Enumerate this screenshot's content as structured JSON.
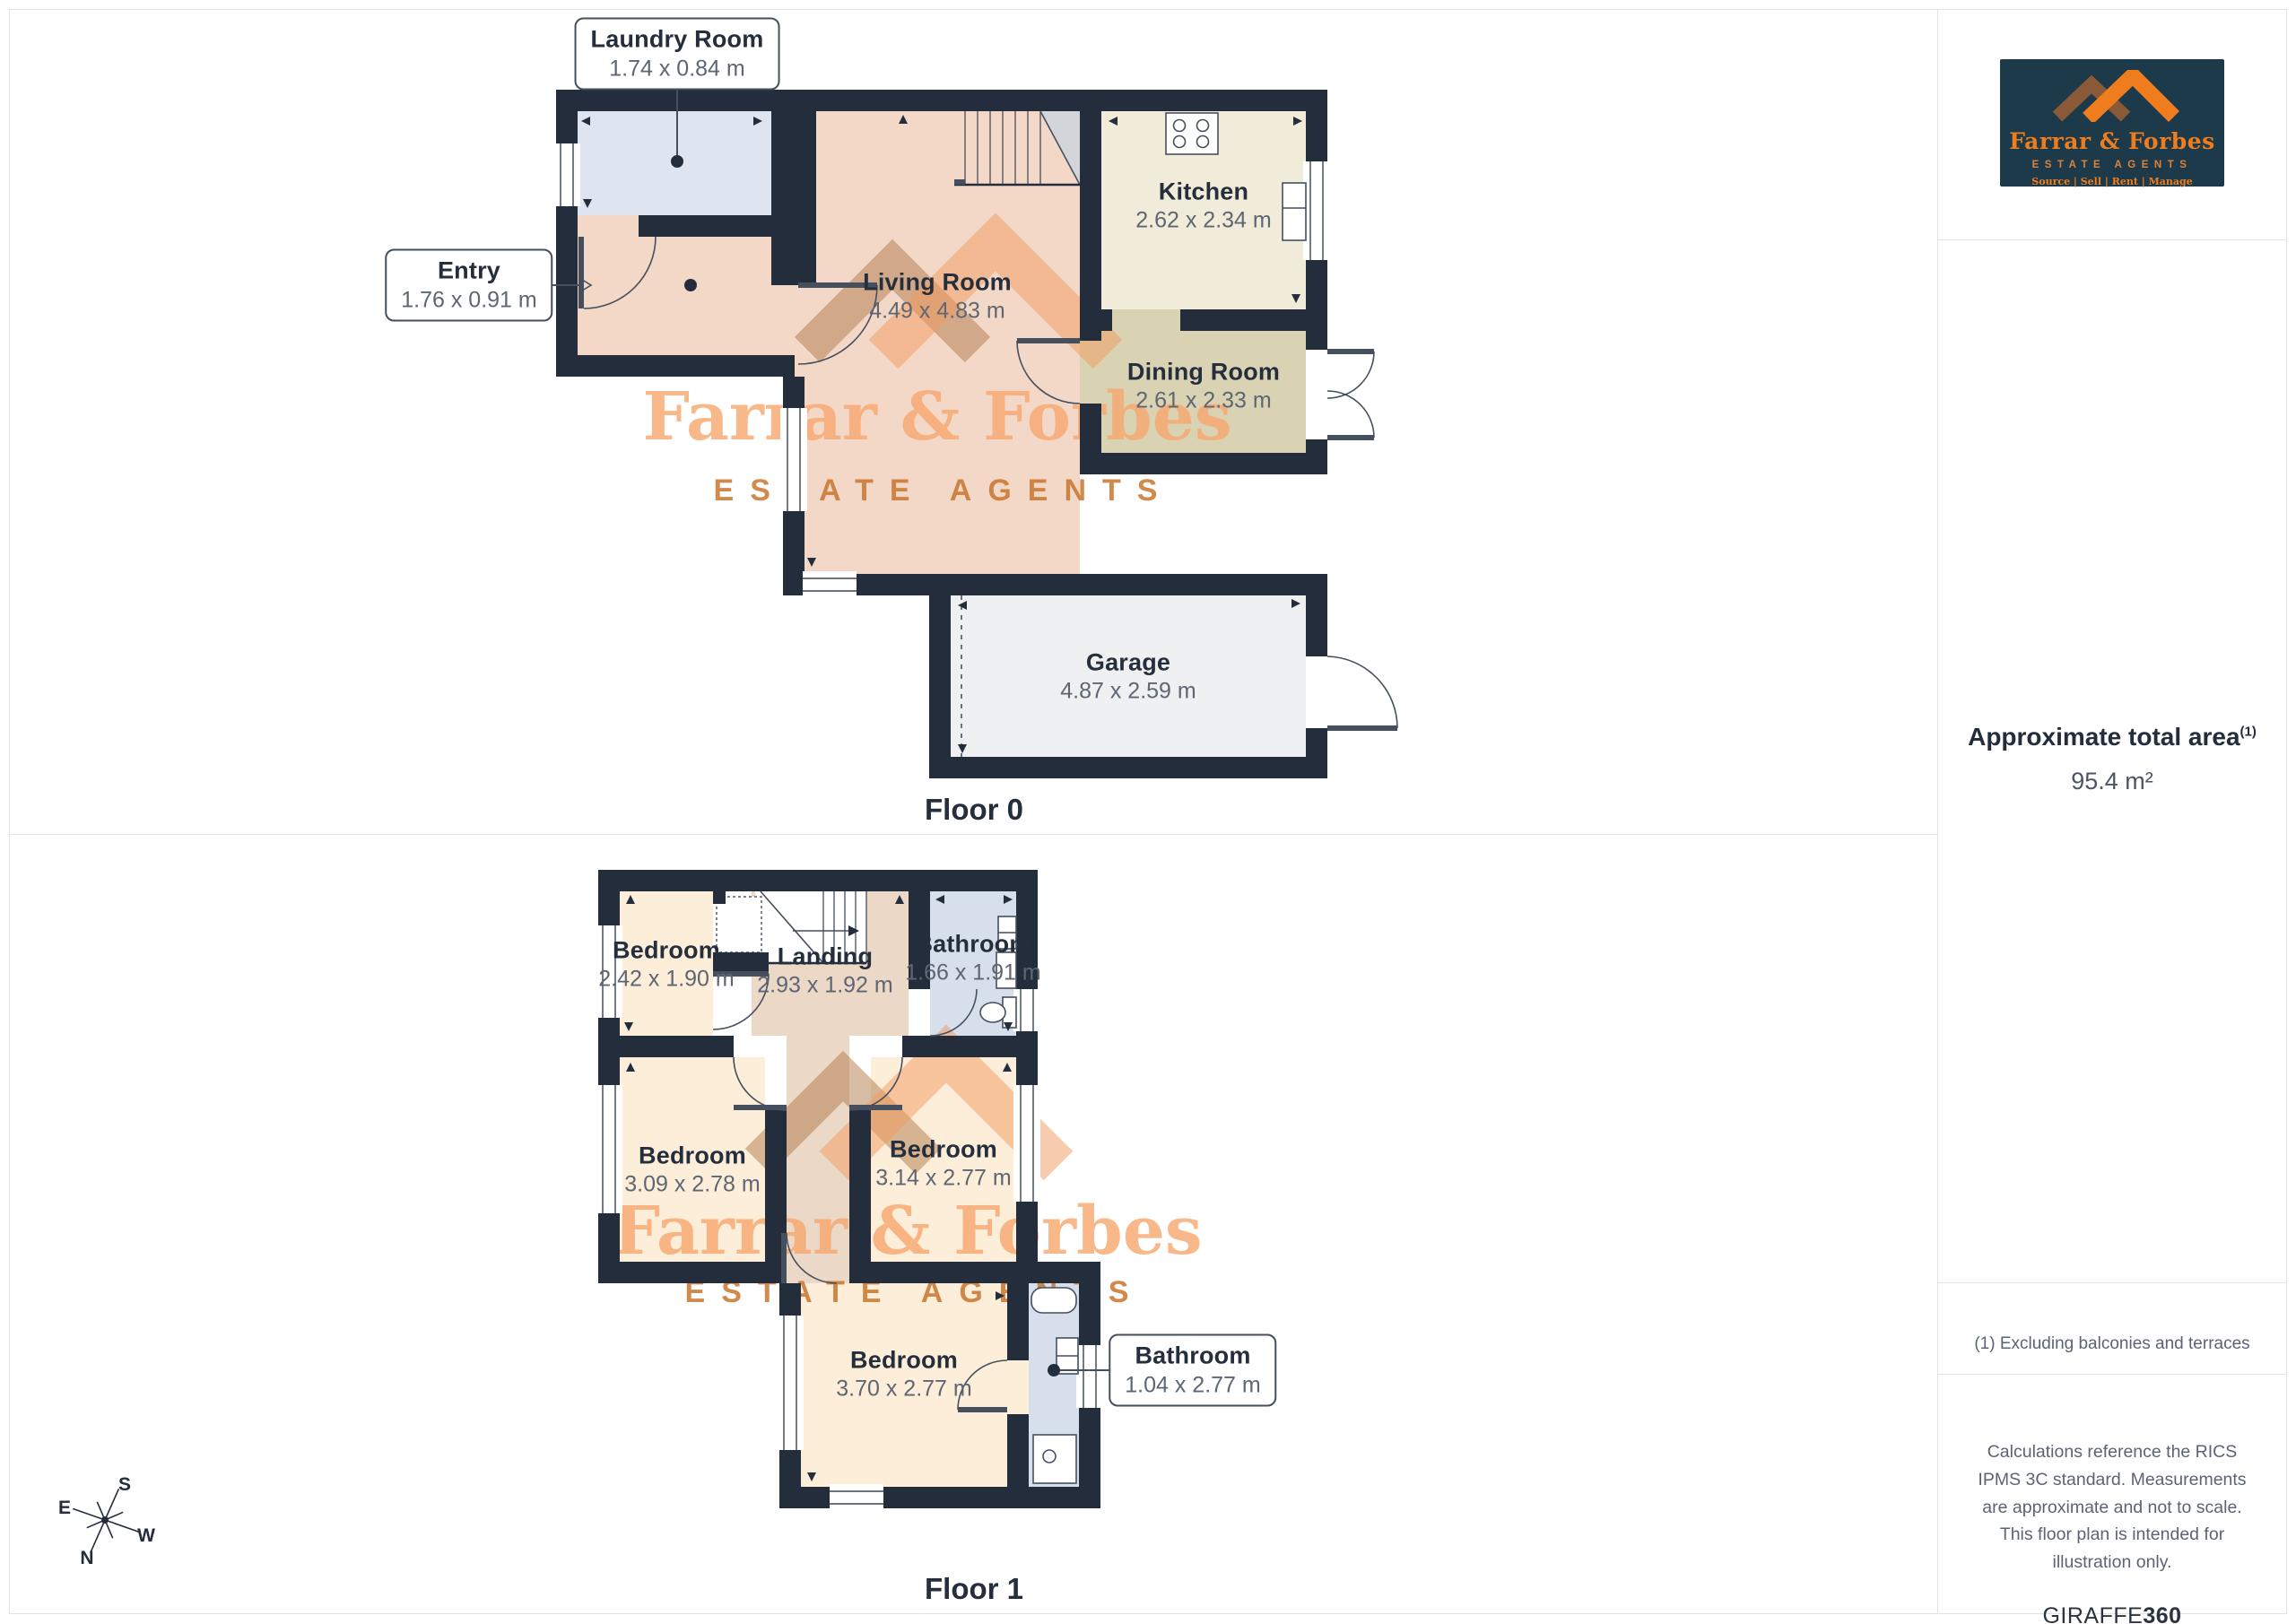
{
  "floor0": {
    "label": "Floor 0",
    "rooms": {
      "living": {
        "name": "Living Room",
        "dims": "4.49 x 4.83 m"
      },
      "kitchen": {
        "name": "Kitchen",
        "dims": "2.62 x 2.34 m"
      },
      "dining": {
        "name": "Dining Room",
        "dims": "2.61 x 2.33 m"
      },
      "garage": {
        "name": "Garage",
        "dims": "4.87 x 2.59 m"
      }
    },
    "callouts": {
      "laundry": {
        "name": "Laundry Room",
        "dims": "1.74 x 0.84 m"
      },
      "entry": {
        "name": "Entry",
        "dims": "1.76 x 0.91 m"
      }
    }
  },
  "floor1": {
    "label": "Floor 1",
    "rooms": {
      "bedroom_small": {
        "name": "Bedroom",
        "dims": "2.42 x 1.90 m"
      },
      "landing": {
        "name": "Landing",
        "dims": "2.93 x 1.92 m"
      },
      "bathroom_top": {
        "name": "Bathroom",
        "dims": "1.66 x 1.91 m"
      },
      "bedroom_left": {
        "name": "Bedroom",
        "dims": "3.09 x 2.78 m"
      },
      "bedroom_right": {
        "name": "Bedroom",
        "dims": "3.14 x 2.77 m"
      },
      "bedroom_big": {
        "name": "Bedroom",
        "dims": "3.70 x 2.77 m"
      }
    },
    "callouts": {
      "bathroom": {
        "name": "Bathroom",
        "dims": "1.04 x 2.77 m"
      }
    }
  },
  "watermark": {
    "name": "Farrar & Forbes",
    "tagline": "ESTATE AGENTS"
  },
  "compass": {
    "n": "N",
    "s": "S",
    "e": "E",
    "w": "W"
  },
  "sidebar": {
    "logo": {
      "name": "Farrar & Forbes",
      "subtitle": "ESTATE AGENTS",
      "tagline": "Source | Sell | Rent | Manage"
    },
    "area_title": "Approximate total area",
    "area_sup": "(1)",
    "area_value": "95.4 m²",
    "footnote": "(1) Excluding balconies and terraces",
    "disclaimer": "Calculations reference the RICS IPMS 3C standard. Measurements are approximate and not to scale. This floor plan is intended for illustration only.",
    "brand": "GIRAFFE",
    "brand_bold": "360"
  },
  "colors": {
    "wall": "#232d3c",
    "living": "#f3d8c8",
    "laundry": "#dfe4f1",
    "kitchen": "#f1ecda",
    "dining": "#d9d2b3",
    "garage": "#eff0f2",
    "bedroom": "#fdeeda",
    "landing": "#ecd8c7",
    "bathroom": "#d7deec",
    "accent_orange": "#ef7d1e",
    "watermark_orange": "#f8a76e",
    "logo_bg": "#1d3a4a"
  }
}
